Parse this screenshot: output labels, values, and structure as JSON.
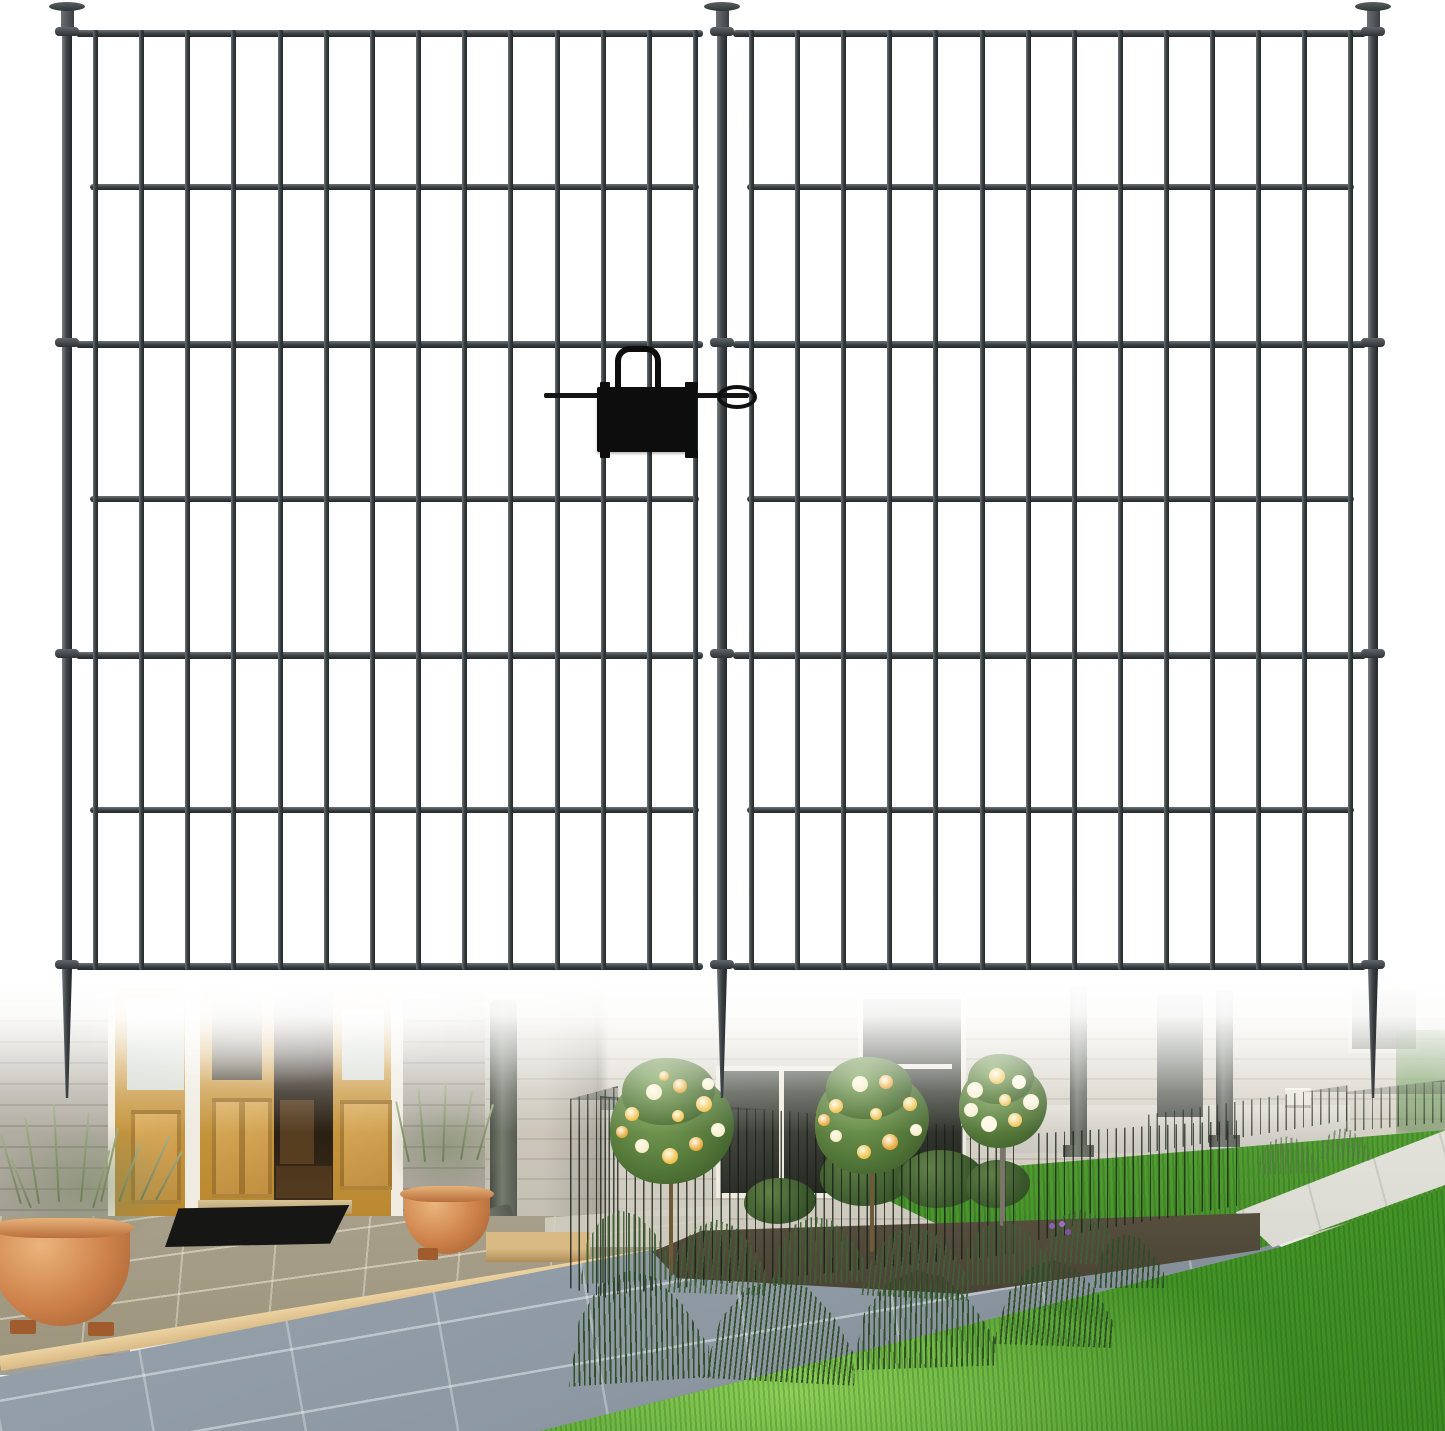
{
  "meta": {
    "alt": "Two black metal no-dig garden fence panels with spiked ground stakes and a black gate latch, shown over a photo of a house front entry with open wooden doors, potted lavender, a fenced garden bed with rose trees, stone paving, a concrete walkway and green lawn"
  },
  "fence": {
    "color_dark": "#23282a",
    "color_mid": "#3a4043",
    "color_light": "#6f7577",
    "bar_width": 5,
    "rail_height": 7,
    "bar_top": 30,
    "bar_bottom": 970,
    "long_rail_ys": [
      30,
      341,
      652,
      963
    ],
    "short_rail_ys": [
      183,
      495,
      806
    ],
    "panels": [
      {
        "bar_count": 14,
        "bar_start_x": 93,
        "bar_spacing": 46.15,
        "rail_x1": 76,
        "rail_x2": 703,
        "short_x1": 90,
        "short_x2": 699
      },
      {
        "bar_count": 14,
        "bar_start_x": 749,
        "bar_spacing": 46.1,
        "rail_x1": 733,
        "rail_x2": 1366,
        "short_x1": 747,
        "short_x2": 1354
      }
    ],
    "stakes": {
      "xs": [
        67,
        722,
        1373
      ],
      "cap_y": 2,
      "cap_w": 36,
      "cap_h": 9,
      "neck_w": 13,
      "stem_w": 10,
      "stem_top": 8,
      "collar_ys": [
        27,
        338,
        649,
        960
      ],
      "collar_w": 24,
      "collar_h": 9,
      "spike_top": 969,
      "spike_tip": 1098
    },
    "latch": {
      "color": "#0d0d0d",
      "plate": {
        "x": 597,
        "y": 387,
        "w": 100,
        "h": 65
      },
      "handle": {
        "x": 615,
        "y": 346,
        "w": 34,
        "h": 48
      },
      "rod": {
        "x1": 544,
        "x2": 749,
        "y": 393,
        "h": 5
      },
      "eyelet": {
        "x": 717,
        "y": 385,
        "w": 32,
        "h": 16
      },
      "tabs": [
        [
          600,
          382,
          10,
          8
        ],
        [
          600,
          450,
          10,
          8
        ],
        [
          685,
          382,
          13,
          8
        ],
        [
          685,
          450,
          13,
          8
        ]
      ]
    }
  },
  "photo": {
    "top": 980,
    "height": 451,
    "palette": {
      "fence-dark": "#23282a",
      "fence-mid": "#3a4043",
      "fence-light": "#6f7577",
      "latch-black": "#0d0d0d",
      "wall-left-light": "#c6c2b8",
      "wall-left-dark": "#a39e94",
      "wall-mid-light": "#e3dfd5",
      "wall-mid-dark": "#cdc8bc",
      "trim-white": "#efebe0",
      "oak-light": "#d8a855",
      "oak-dark": "#b9882f",
      "opening-dark": "#170f08",
      "glass-pale": "#ccd1c9",
      "glass-dark": "#3d4038",
      "mat-black": "#161614",
      "terracotta": "#cd8049",
      "terracotta-light": "#eab57b",
      "lavender-green": "#7d8c66",
      "tile-olive": "#9c937c",
      "tan-step": "#d9ba85",
      "tile-blue": "#8c97a1",
      "lawn-front": "#4a9c2c",
      "lawn-light": "#8ed058",
      "lawn-mid": "#47902b",
      "walkway": "#dadad2",
      "mulch": "#4a4336",
      "foliage-light": "#7fa45b",
      "foliage-dark": "#3c5c2a",
      "downspout": "#565b52",
      "post-grey": "#5e625a"
    },
    "trees": [
      {
        "cx": 672,
        "cy": 148,
        "rx": 62,
        "ry": 56,
        "trunk": {
          "x": 669,
          "y": 200,
          "w": 4,
          "h": 96,
          "color": "#6e5a39"
        },
        "flower_colors": [
          "#f1c14a",
          "#f7edca",
          "#e9a93e"
        ],
        "flowers": [
          [
            -40,
            -14,
            7
          ],
          [
            -18,
            -36,
            8
          ],
          [
            8,
            -42,
            7
          ],
          [
            32,
            -24,
            8
          ],
          [
            46,
            2,
            7
          ],
          [
            24,
            16,
            7
          ],
          [
            -2,
            28,
            8
          ],
          [
            -30,
            18,
            7
          ],
          [
            -50,
            4,
            6
          ],
          [
            6,
            -12,
            6
          ],
          [
            36,
            -44,
            6
          ],
          [
            -8,
            -52,
            5
          ]
        ]
      },
      {
        "cx": 872,
        "cy": 142,
        "rx": 57,
        "ry": 52,
        "trunk": {
          "x": 870,
          "y": 192,
          "w": 4,
          "h": 80,
          "color": "#6e5a39"
        },
        "flower_colors": [
          "#f1c14a",
          "#f7edca",
          "#e9a93e"
        ],
        "flowers": [
          [
            -36,
            -16,
            7
          ],
          [
            -12,
            -38,
            8
          ],
          [
            14,
            -40,
            7
          ],
          [
            38,
            -18,
            7
          ],
          [
            44,
            8,
            6
          ],
          [
            18,
            20,
            8
          ],
          [
            -8,
            30,
            7
          ],
          [
            -36,
            14,
            6
          ],
          [
            -48,
            -2,
            6
          ],
          [
            4,
            -8,
            6
          ]
        ]
      },
      {
        "cx": 1003,
        "cy": 126,
        "rx": 44,
        "ry": 42,
        "trunk": {
          "x": 1000,
          "y": 166,
          "w": 5,
          "h": 80,
          "color": "#7b7468"
        },
        "flower_colors": [
          "#f6eed4",
          "#f1c75e",
          "#fdf6e3"
        ],
        "flowers": [
          [
            -28,
            -16,
            8
          ],
          [
            -6,
            -30,
            8
          ],
          [
            16,
            -24,
            7
          ],
          [
            28,
            -4,
            8
          ],
          [
            12,
            14,
            7
          ],
          [
            -14,
            18,
            8
          ],
          [
            -32,
            4,
            7
          ],
          [
            2,
            -6,
            6
          ]
        ]
      }
    ],
    "lavender_shades": [
      "rgba(63,97,52,0.92)",
      "rgba(44,76,36,0.95)",
      "rgba(88,114,76,0.65)"
    ],
    "lavender_clumps": [
      [
        578,
        230,
        92,
        72,
        -3,
        0
      ],
      [
        668,
        240,
        100,
        74,
        2,
        0
      ],
      [
        770,
        236,
        96,
        68,
        -2,
        0
      ],
      [
        862,
        246,
        108,
        72,
        3,
        0
      ],
      [
        958,
        240,
        92,
        64,
        -3,
        0
      ],
      [
        1042,
        230,
        78,
        54,
        2,
        0
      ],
      [
        565,
        290,
        142,
        112,
        -4,
        1
      ],
      [
        705,
        298,
        152,
        104,
        3,
        1
      ],
      [
        850,
        290,
        144,
        98,
        -2,
        1
      ],
      [
        995,
        280,
        120,
        86,
        2,
        1
      ],
      [
        1092,
        254,
        72,
        54,
        0,
        1
      ],
      [
        1255,
        156,
        64,
        38,
        -2,
        2
      ],
      [
        1318,
        148,
        52,
        32,
        2,
        2
      ]
    ],
    "garden_fence": [
      [
        570,
        106,
        48,
        215,
        "0 6%,100% 0,100% 100%,0 94%",
        0.95
      ],
      [
        600,
        116,
        415,
        200,
        "0 0,100% 17%,100% 79%,0 100%",
        0.92
      ],
      [
        1038,
        125,
        205,
        135,
        "0 21%,100% 11%,100% 74%,0 100%",
        0.88
      ],
      [
        1148,
        98,
        200,
        80,
        "0 46%,100% 9%,100% 53%,0 93%",
        0.8
      ],
      [
        1346,
        100,
        99,
        70,
        "0 17%,100% 0,100% 60%,0 74%",
        0.75
      ]
    ],
    "pot_stems": [
      [
        20,
        152,
        72,
        -16
      ],
      [
        38,
        136,
        88,
        -9
      ],
      [
        58,
        124,
        98,
        -3
      ],
      [
        80,
        132,
        90,
        5
      ],
      [
        100,
        146,
        76,
        13
      ],
      [
        118,
        160,
        62,
        20
      ],
      [
        30,
        172,
        56,
        -22
      ],
      [
        92,
        168,
        60,
        16
      ],
      [
        140,
        150,
        70,
        24
      ],
      [
        155,
        165,
        55,
        28
      ],
      [
        408,
        120,
        62,
        -12
      ],
      [
        424,
        108,
        74,
        -5
      ],
      [
        442,
        102,
        80,
        2
      ],
      [
        460,
        110,
        70,
        9
      ],
      [
        476,
        122,
        58,
        16
      ]
    ]
  }
}
